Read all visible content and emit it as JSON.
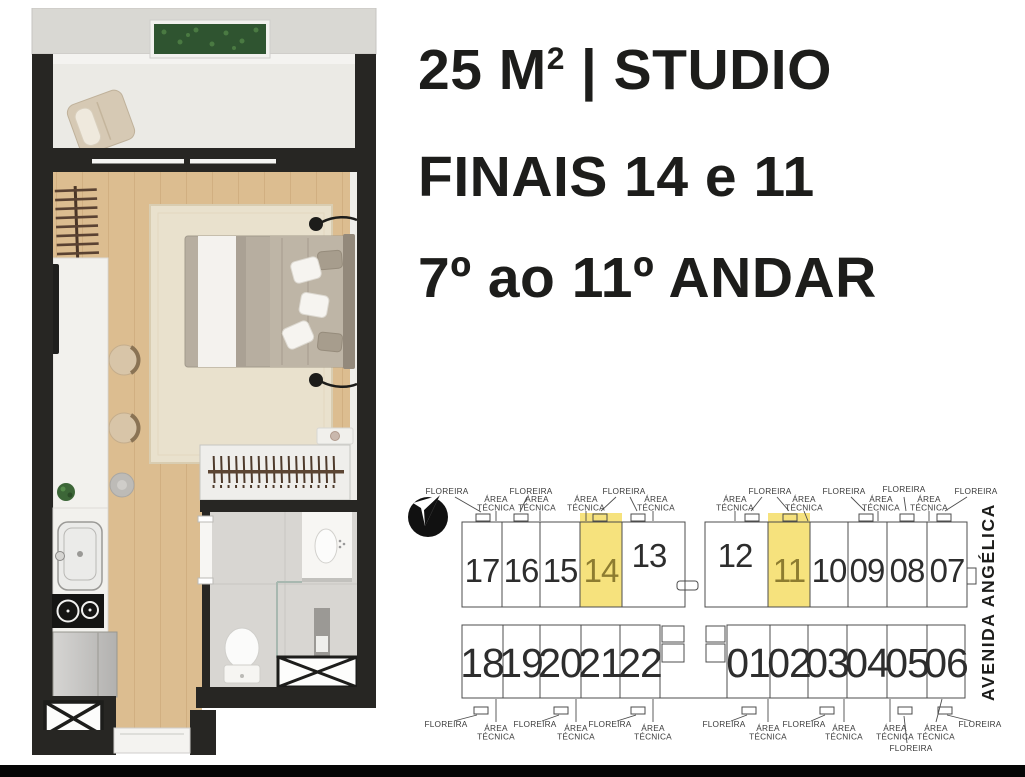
{
  "headline": {
    "area_value": "25 M",
    "area_sup": "2",
    "area_rest": " | STUDIO",
    "finals": "FINAIS 14 e 11",
    "floors": "7º ao 11º ANDAR",
    "text_color": "#1d1d1b"
  },
  "floor_plan": {
    "colors": {
      "wall": "#272623",
      "wood_floor": "#dcbd90",
      "rug": "#e9e1cd",
      "balcony_floor": "#ebeae5",
      "top_ledge": "#d9d8d3",
      "planter_green": "#2f5430",
      "bed_blanket": "#b7aea0",
      "tile_floor": "#d8d6d2",
      "counter_white": "#f2f1ed"
    },
    "features": [
      "planter-box",
      "lounge-chair",
      "sliding-glass-door",
      "ladder-rack",
      "wall-tv",
      "kitchen-counter",
      "counter-stools",
      "area-rug",
      "double-bed",
      "wall-lamps",
      "nightstand",
      "potted-plant",
      "wardrobe-rack",
      "kitchen-sink",
      "two-burner-cooktop",
      "refrigerator",
      "entry-door",
      "bathroom-vanity",
      "glass-shower",
      "toilet",
      "service-shafts"
    ]
  },
  "key_plan": {
    "street_label": "AVENIDA ANGÉLICA",
    "line_color": "#4c4c4c",
    "number_color": "#2d2d2d",
    "highlight_color": "#f6e27d",
    "highlight_text_color": "#8d7c30",
    "label_color": "#3b3b3b",
    "highlighted_units": [
      "14",
      "11"
    ],
    "units_top": [
      {
        "n": "17",
        "x": 82,
        "y": 102,
        "s": 33
      },
      {
        "n": "16",
        "x": 121,
        "y": 102,
        "s": 33
      },
      {
        "n": "15",
        "x": 160,
        "y": 102,
        "s": 33
      },
      {
        "n": "14",
        "x": 201,
        "y": 102,
        "s": 33,
        "hl": true
      },
      {
        "n": "13",
        "x": 249,
        "y": 87,
        "s": 33
      },
      {
        "n": "12",
        "x": 335,
        "y": 87,
        "s": 33
      },
      {
        "n": "11",
        "x": 389,
        "y": 102,
        "s": 33,
        "hl": true
      },
      {
        "n": "10",
        "x": 429,
        "y": 102,
        "s": 33
      },
      {
        "n": "09",
        "x": 467,
        "y": 102,
        "s": 33
      },
      {
        "n": "08",
        "x": 507,
        "y": 102,
        "s": 33
      },
      {
        "n": "07",
        "x": 547,
        "y": 102,
        "s": 33
      }
    ],
    "units_bottom": [
      {
        "n": "18",
        "x": 82,
        "y": 197,
        "s": 41
      },
      {
        "n": "19",
        "x": 121,
        "y": 197,
        "s": 41
      },
      {
        "n": "20",
        "x": 160,
        "y": 197,
        "s": 41
      },
      {
        "n": "21",
        "x": 200,
        "y": 197,
        "s": 41
      },
      {
        "n": "22",
        "x": 240,
        "y": 197,
        "s": 41
      },
      {
        "n": "01",
        "x": 348,
        "y": 197,
        "s": 41
      },
      {
        "n": "02",
        "x": 389,
        "y": 197,
        "s": 41
      },
      {
        "n": "03",
        "x": 427,
        "y": 197,
        "s": 41
      },
      {
        "n": "04",
        "x": 467,
        "y": 197,
        "s": 41
      },
      {
        "n": "05",
        "x": 507,
        "y": 197,
        "s": 41
      },
      {
        "n": "06",
        "x": 546,
        "y": 197,
        "s": 41
      }
    ],
    "labels_top": [
      {
        "t": "FLOREIRA",
        "x": 47,
        "y": 14
      },
      {
        "t": "ÁREA TÉCNICA",
        "x": 96,
        "y": 22
      },
      {
        "t": "FLOREIRA",
        "x": 131,
        "y": 14
      },
      {
        "t": "ÁREA TÉCNICA",
        "x": 137,
        "y": 22
      },
      {
        "t": "ÁREA TÉCNICA",
        "x": 186,
        "y": 22
      },
      {
        "t": "FLOREIRA",
        "x": 224,
        "y": 14
      },
      {
        "t": "ÁREA TÉCNICA",
        "x": 256,
        "y": 22
      },
      {
        "t": "ÁREA TÉCNICA",
        "x": 335,
        "y": 22
      },
      {
        "t": "FLOREIRA",
        "x": 370,
        "y": 14
      },
      {
        "t": "ÁREA TÉCNICA",
        "x": 404,
        "y": 22
      },
      {
        "t": "FLOREIRA",
        "x": 444,
        "y": 14
      },
      {
        "t": "ÁREA TÉCNICA",
        "x": 481,
        "y": 22
      },
      {
        "t": "FLOREIRA",
        "x": 504,
        "y": 12
      },
      {
        "t": "ÁREA TÉCNICA",
        "x": 529,
        "y": 22
      },
      {
        "t": "FLOREIRA",
        "x": 576,
        "y": 14
      }
    ],
    "labels_bottom": [
      {
        "t": "FLOREIRA",
        "x": 46,
        "y": 247
      },
      {
        "t": "ÁREA TÉCNICA",
        "x": 96,
        "y": 251
      },
      {
        "t": "FLOREIRA",
        "x": 135,
        "y": 247
      },
      {
        "t": "ÁREA TÉCNICA",
        "x": 176,
        "y": 251
      },
      {
        "t": "FLOREIRA",
        "x": 210,
        "y": 247
      },
      {
        "t": "ÁREA TÉCNICA",
        "x": 253,
        "y": 251
      },
      {
        "t": "FLOREIRA",
        "x": 324,
        "y": 247
      },
      {
        "t": "ÁREA TÉCNICA",
        "x": 368,
        "y": 251
      },
      {
        "t": "FLOREIRA",
        "x": 404,
        "y": 247
      },
      {
        "t": "ÁREA TÉCNICA",
        "x": 444,
        "y": 251
      },
      {
        "t": "ÁREA TÉCNICA",
        "x": 495,
        "y": 251
      },
      {
        "t": "FLOREIRA",
        "x": 511,
        "y": 271
      },
      {
        "t": "ÁREA TÉCNICA",
        "x": 536,
        "y": 251
      },
      {
        "t": "FLOREIRA",
        "x": 580,
        "y": 247
      }
    ]
  },
  "footer": {
    "bar_color": "#060606"
  }
}
